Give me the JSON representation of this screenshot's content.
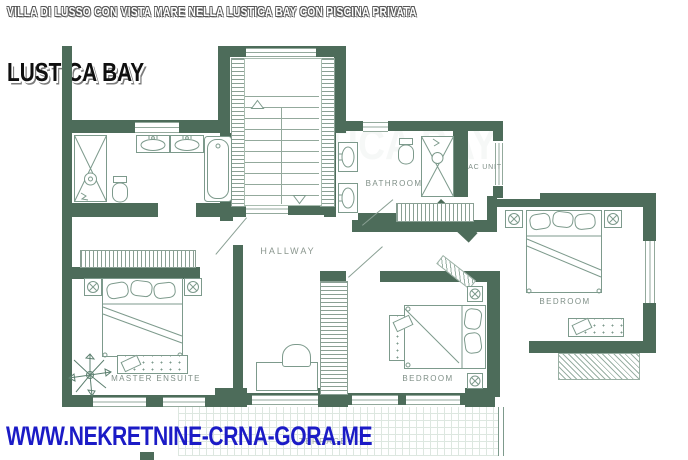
{
  "header": {
    "subtitle": "VILLA DI LUSSO CON VISTA MARE NELLA LUSTICA BAY CON PISCINA PRIVATA",
    "title": "LUSTICA BAY"
  },
  "watermark": "LUSTICA BAY",
  "rooms": {
    "bathroom": "BATHROOM",
    "ac_unit": "AC UNIT",
    "hallway": "HALLWAY",
    "master_ensuite": "MASTER ENSUITE",
    "bedroom_middle": "BEDROOM",
    "bedroom_right": "BEDROOM",
    "terrace": "TERRACE"
  },
  "footer": {
    "website": "WWW.NEKRETNINE-CRNA-GORA.ME"
  },
  "colors": {
    "wall_green": "#4d6c5a",
    "furniture_line": "#7d9a8c",
    "label_gray": "#7f8f87",
    "website_blue": "#1b1bc6"
  }
}
